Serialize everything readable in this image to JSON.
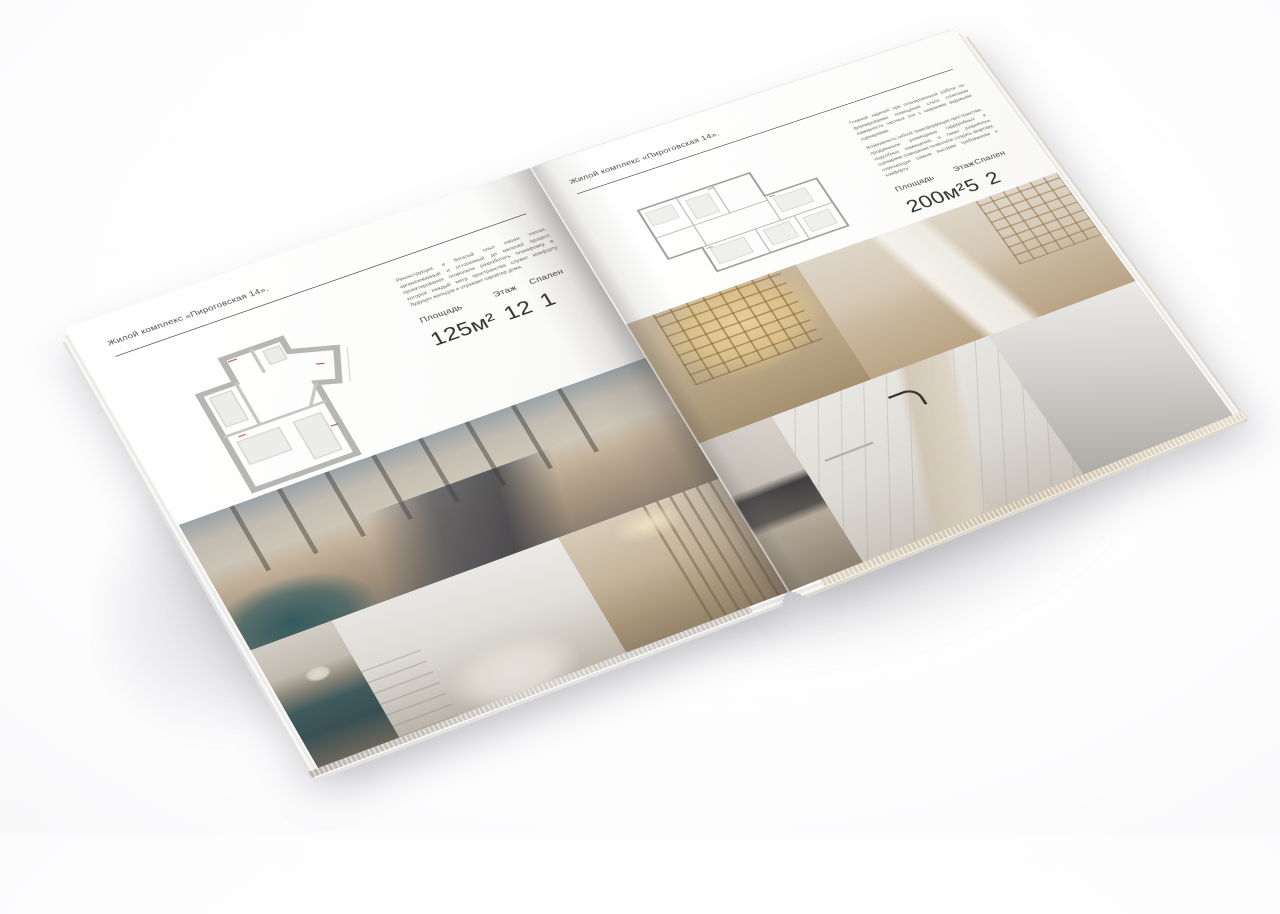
{
  "scene": {
    "background_color": "#fdfdfe",
    "subject": "Разворот квадратной брошюры жилого комплекса, лежащей на белой поверхности"
  },
  "brochure": {
    "accent_rule_color": "#56534e",
    "pages": [
      {
        "side": "left",
        "header": "Жилой комплекс «Пироговская 14».",
        "description": "Реконструкция и богатый опыт наших коллег, организованный и отточенный до мелочей процесс проектирования позволили разработать планировку, в которой каждый метр пространства служит комфорту будущих жильцов и отражает характер дома.",
        "floor_plan": "floor-plan-apartment-125m2",
        "stats": [
          {
            "label": "Площадь",
            "value": "125м²"
          },
          {
            "label": "Этаж",
            "value": "12"
          },
          {
            "label": "Спален",
            "value": "1"
          }
        ],
        "photos": [
          "master-bedroom-panorama",
          "teal-console-with-flowers",
          "light-nursery-bedroom",
          "dressing-hall-shelving"
        ]
      },
      {
        "side": "right",
        "header": "Жилой комплекс «Пироговская 14».",
        "description_1": "Главной задачей при планировочной работе по формированию помещений стало сочетание камерности частных зон с широкими видовыми сценариями.",
        "description_2": "Возможность гибкой трансформации пространства, продуманное размещение гардеробных и подсобных помещений, а также разработка сценариев освещения позволили создать квартиру, отвечающую самым высоким требованиям к комфорту.",
        "floor_plan": "floor-plan-apartment-200m2",
        "stats": [
          {
            "label": "Площадь",
            "value": "200м²"
          },
          {
            "label": "Этаж",
            "value": "5"
          },
          {
            "label": "Спален",
            "value": "2"
          }
        ],
        "photos": [
          "walk-in-wardrobe",
          "home-office-with-bookshelves",
          "kitchen-dark-counter",
          "marble-bathroom",
          "grey-wall-detail"
        ]
      }
    ]
  }
}
